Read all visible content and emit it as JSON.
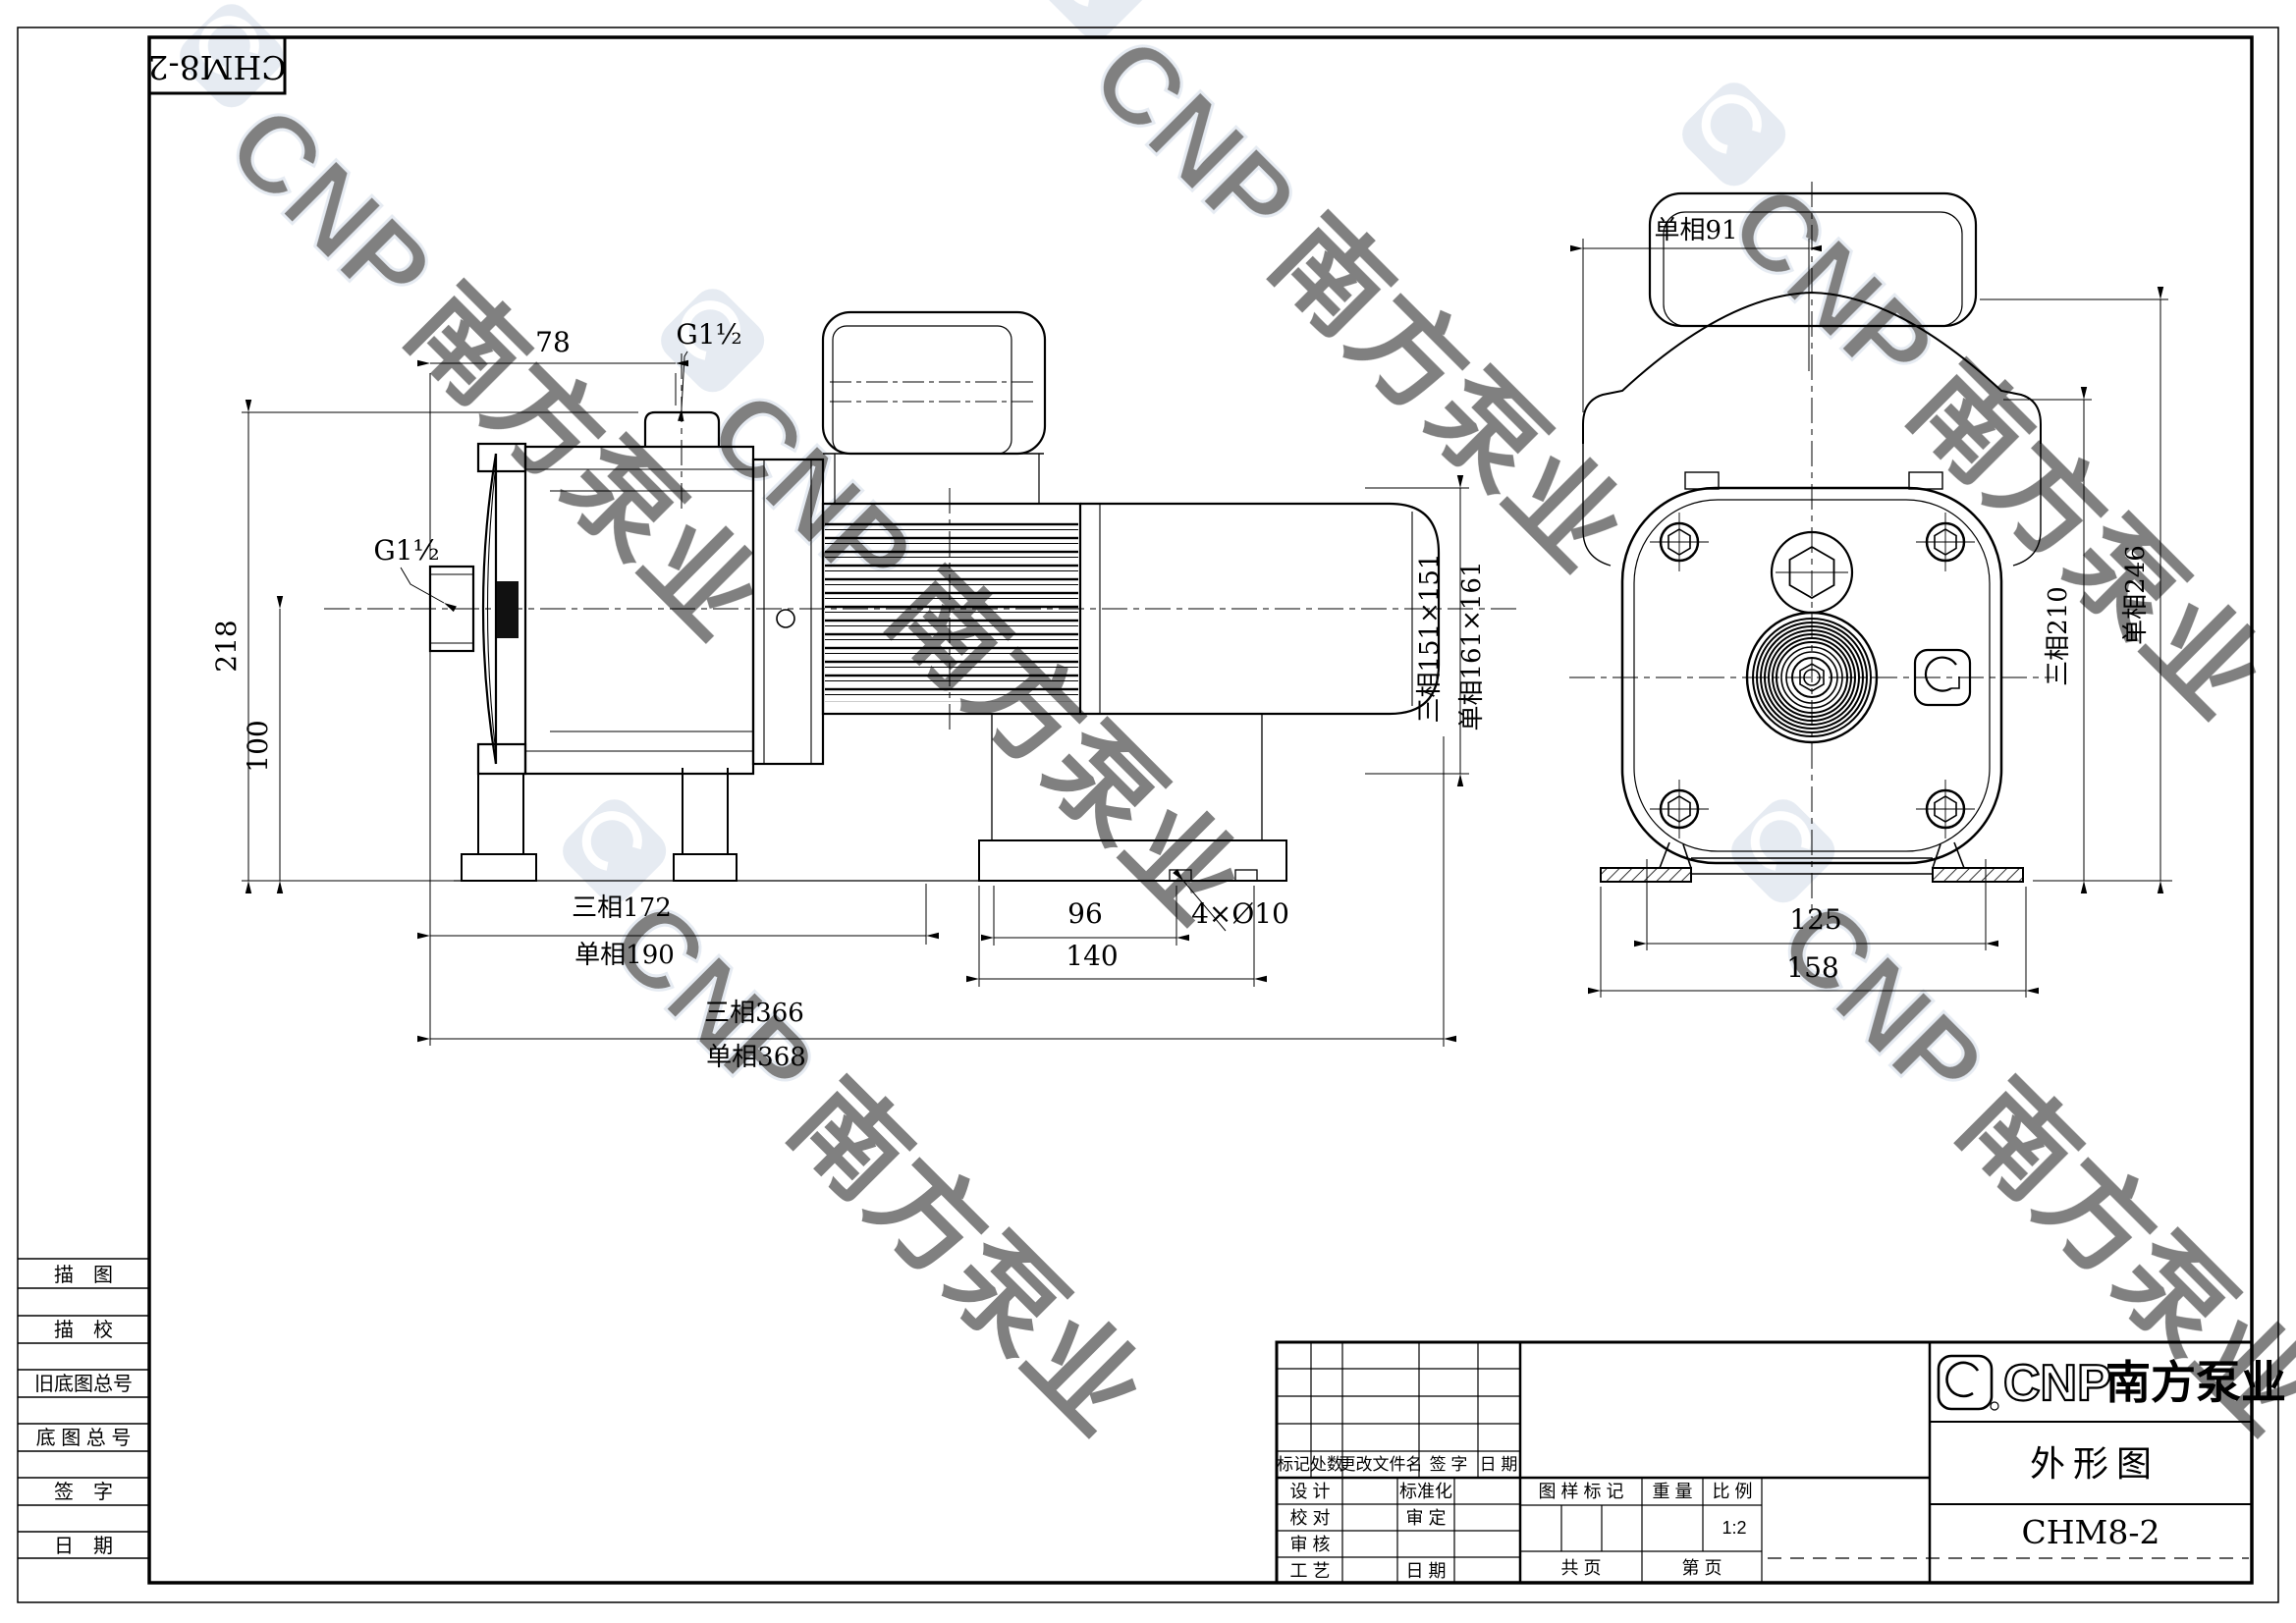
{
  "page": {
    "model_box": "CHM8-2"
  },
  "watermark": {
    "cnp": "CNP",
    "name": "南方泵业"
  },
  "side_view": {
    "dims": {
      "top_width": "78",
      "port_top": "G1½",
      "height": "218",
      "port_left": "G1½",
      "base_height": "100",
      "len_3ph": "三相172",
      "len_1ph": "单相190",
      "foot_hole_span": "96",
      "foot_len": "140",
      "holes": "4×Ø10",
      "total_3ph": "三相366",
      "total_1ph": "单相368"
    }
  },
  "between": {
    "sq_3ph": "三相151×151",
    "sq_1ph": "单相161×161"
  },
  "front_view": {
    "dims": {
      "box_w": "单相91",
      "h_3ph": "三相210",
      "h_1ph": "单相246",
      "foot_span": "125",
      "foot_w": "158"
    }
  },
  "sidebar": {
    "items": [
      "描　图",
      "描　校",
      "旧底图总号",
      "底 图 总 号",
      "签　字",
      "日　期"
    ]
  },
  "title_block": {
    "rev_headers": [
      "标记",
      "处数",
      "更改文件名",
      "签  字",
      "日  期"
    ],
    "sig": {
      "design": "设  计",
      "standard": "标准化",
      "check": "校  对",
      "approve": "审  定",
      "audit": "审  核",
      "process": "工  艺",
      "date": "日  期"
    },
    "stamp": {
      "mark": "图  样  标  记",
      "weight": "重  量",
      "scale_lbl": "比  例",
      "scale_val": "1:2",
      "pages_total": "共       页",
      "page_no": "第       页"
    },
    "brand": {
      "cnp": "CNP",
      "name": "南方泵业"
    },
    "doc_title": "外形图",
    "model": "CHM8-2"
  }
}
